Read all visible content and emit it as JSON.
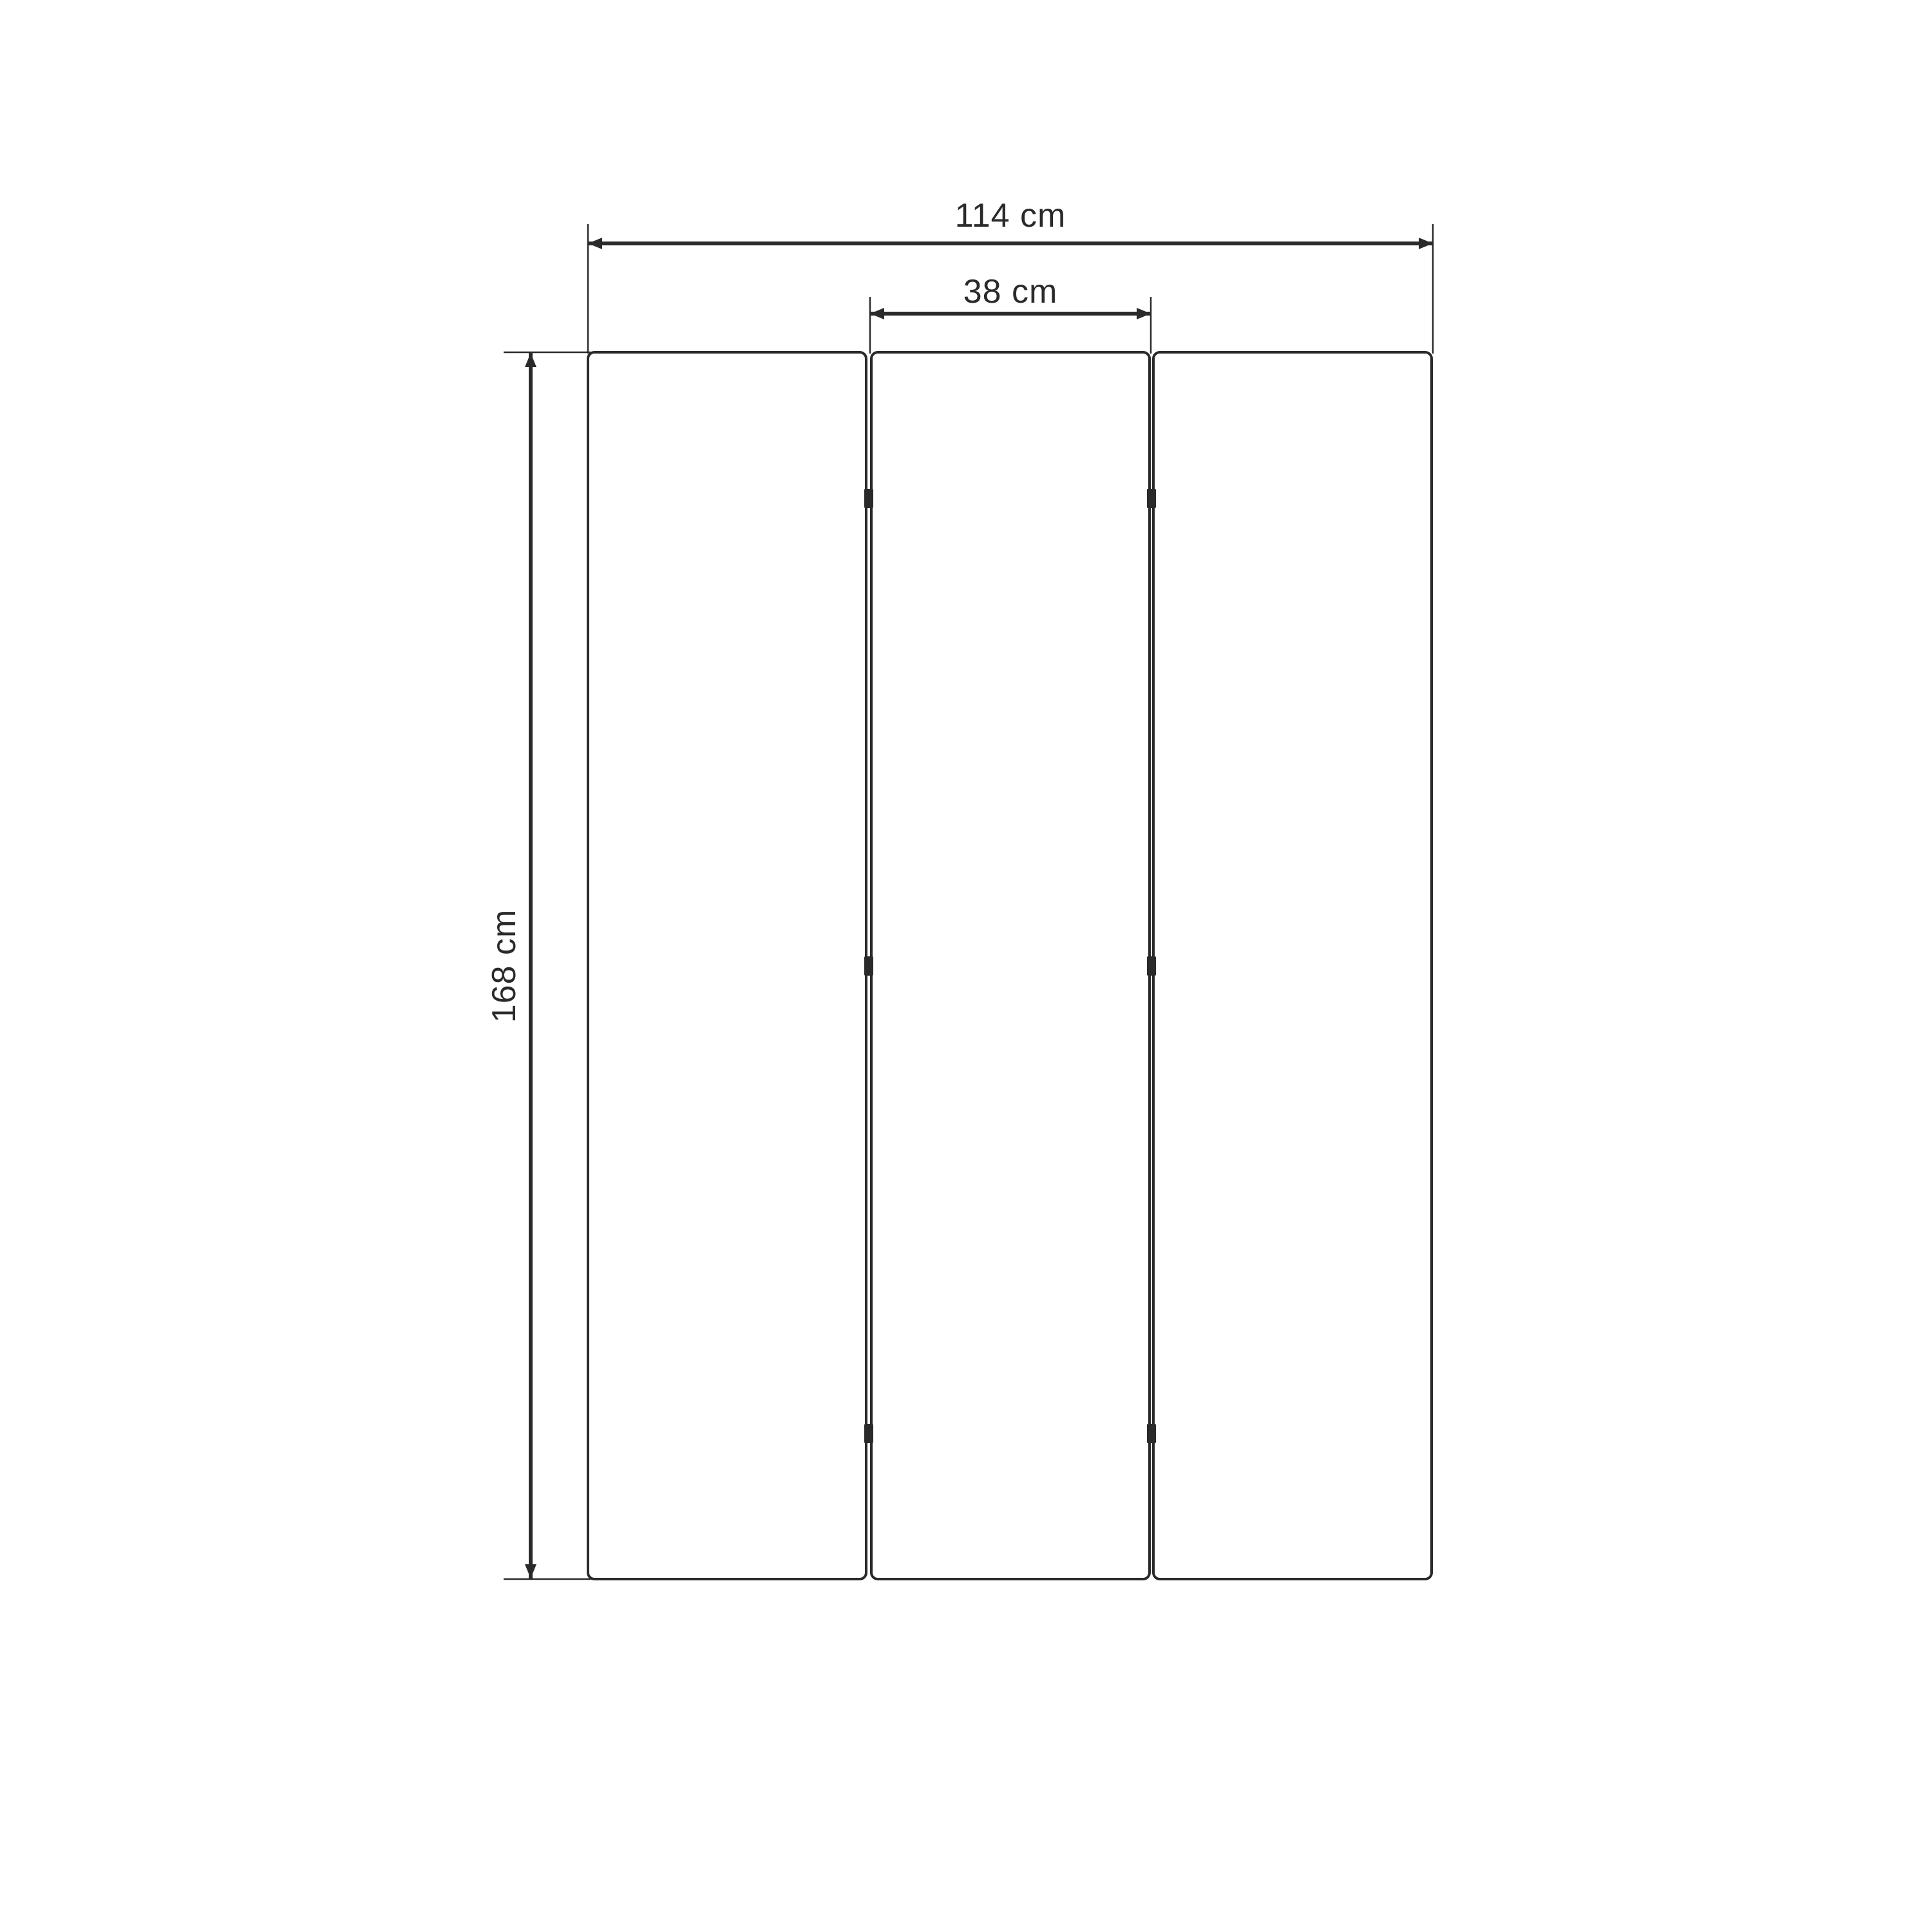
{
  "diagram": {
    "background_color": "#ffffff",
    "line_color": "#2a2a2a",
    "panel_count": 3,
    "dimensions": {
      "total_width": "114 cm",
      "panel_width": "38 cm",
      "height": "168 cm"
    }
  }
}
